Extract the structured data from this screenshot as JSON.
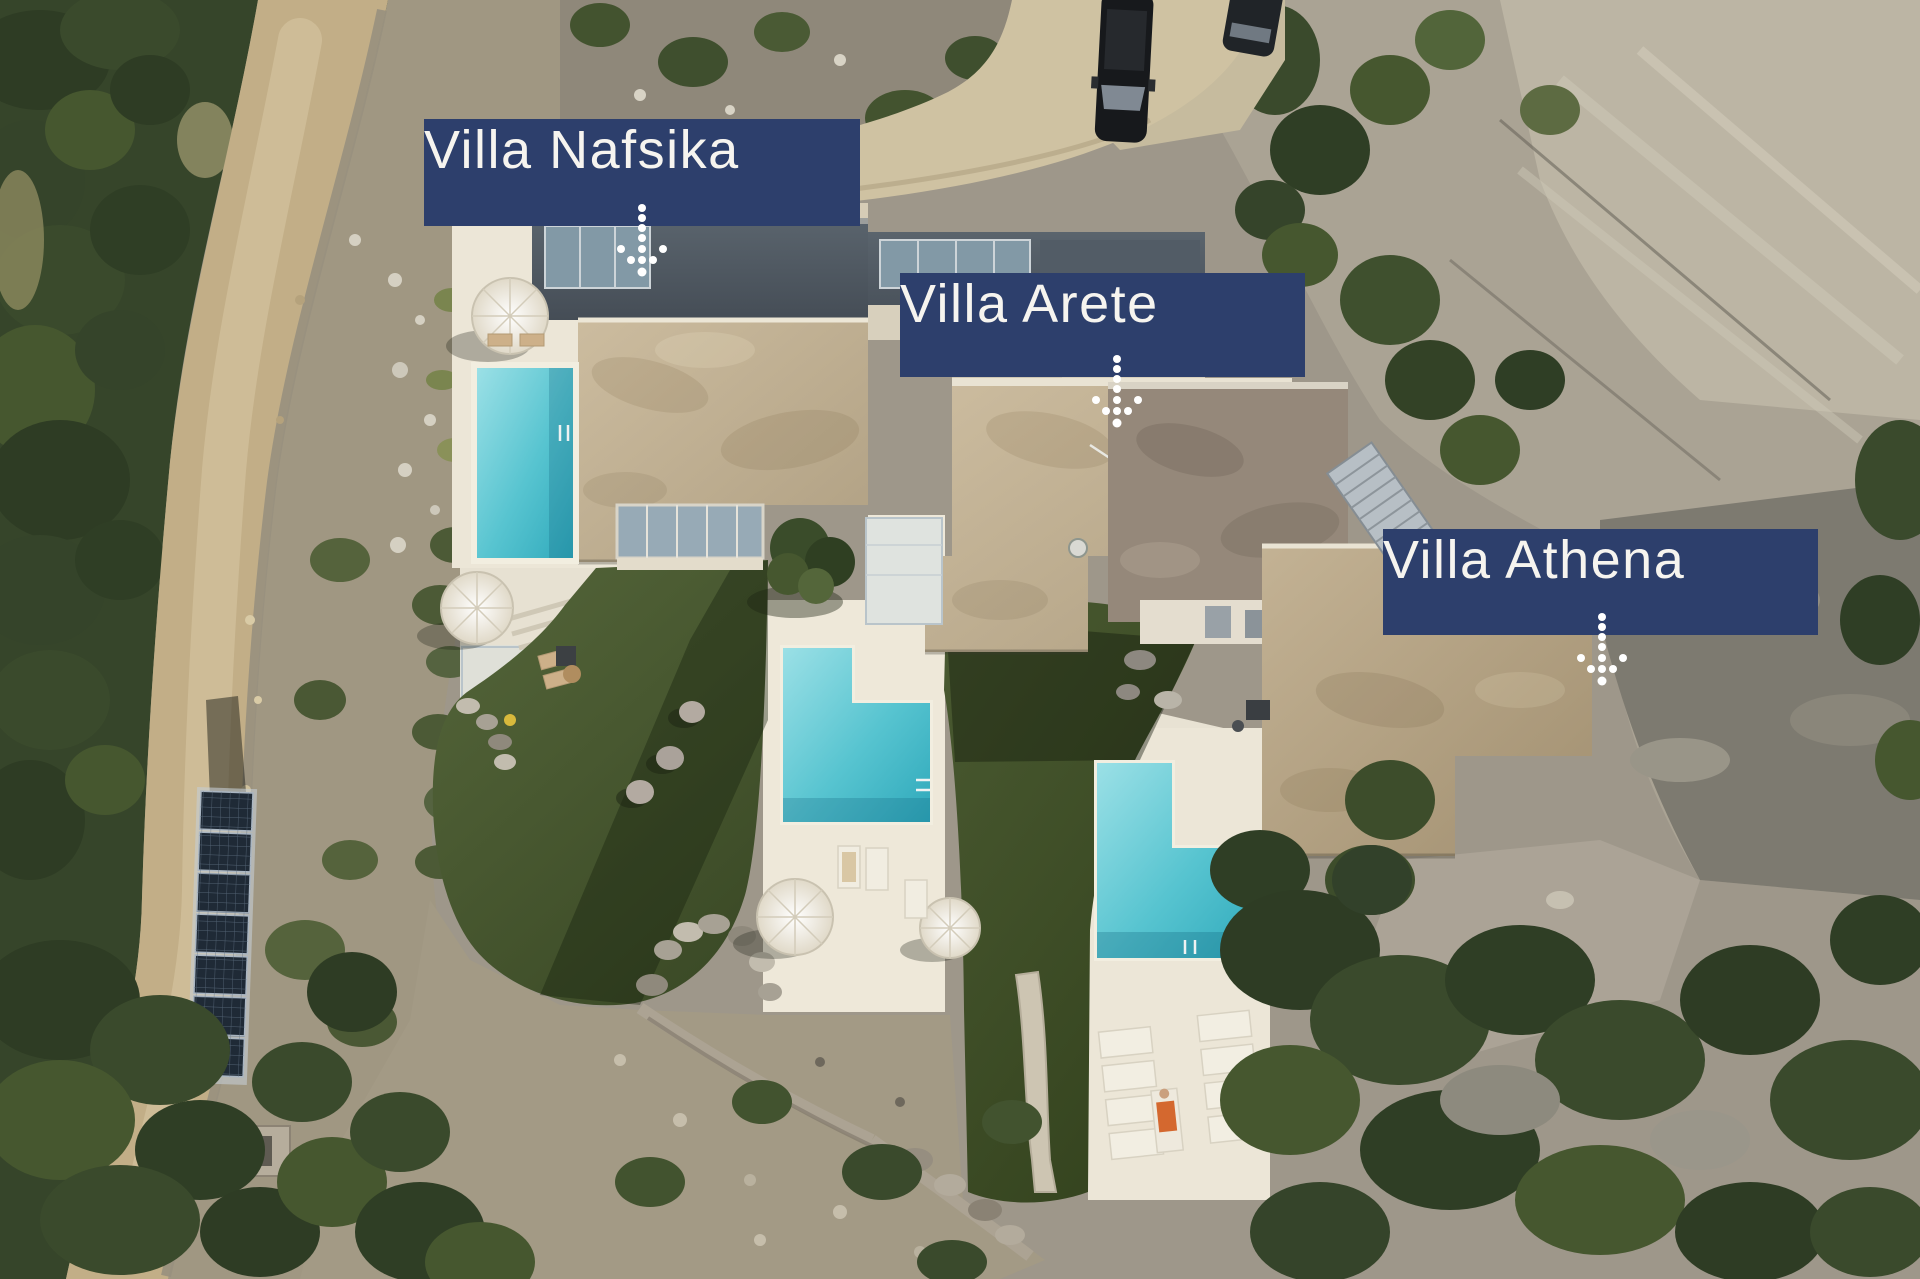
{
  "scene": {
    "alt": "Aerial drone photo of a hillside estate with three modern villas, private pools, lawns, a dirt road and solar panels"
  },
  "labels": {
    "villas": [
      {
        "label": "Villa Nafsika"
      },
      {
        "label": "Villa Arete"
      },
      {
        "label": "Villa Athena"
      }
    ],
    "arrow_icon": "dotted-down-arrow"
  },
  "colors": {
    "label_background": "#2d3f6c",
    "label_text": "#f6f4ef",
    "pool_water": "#58c5d1",
    "lawn_green": "#45562e",
    "roof_beige": "#c3b296",
    "deck_white": "#ece6d7",
    "road_dirt": "#c2ae87",
    "forest_green": "#3a4a2c",
    "rock_gray": "#9e978a"
  }
}
